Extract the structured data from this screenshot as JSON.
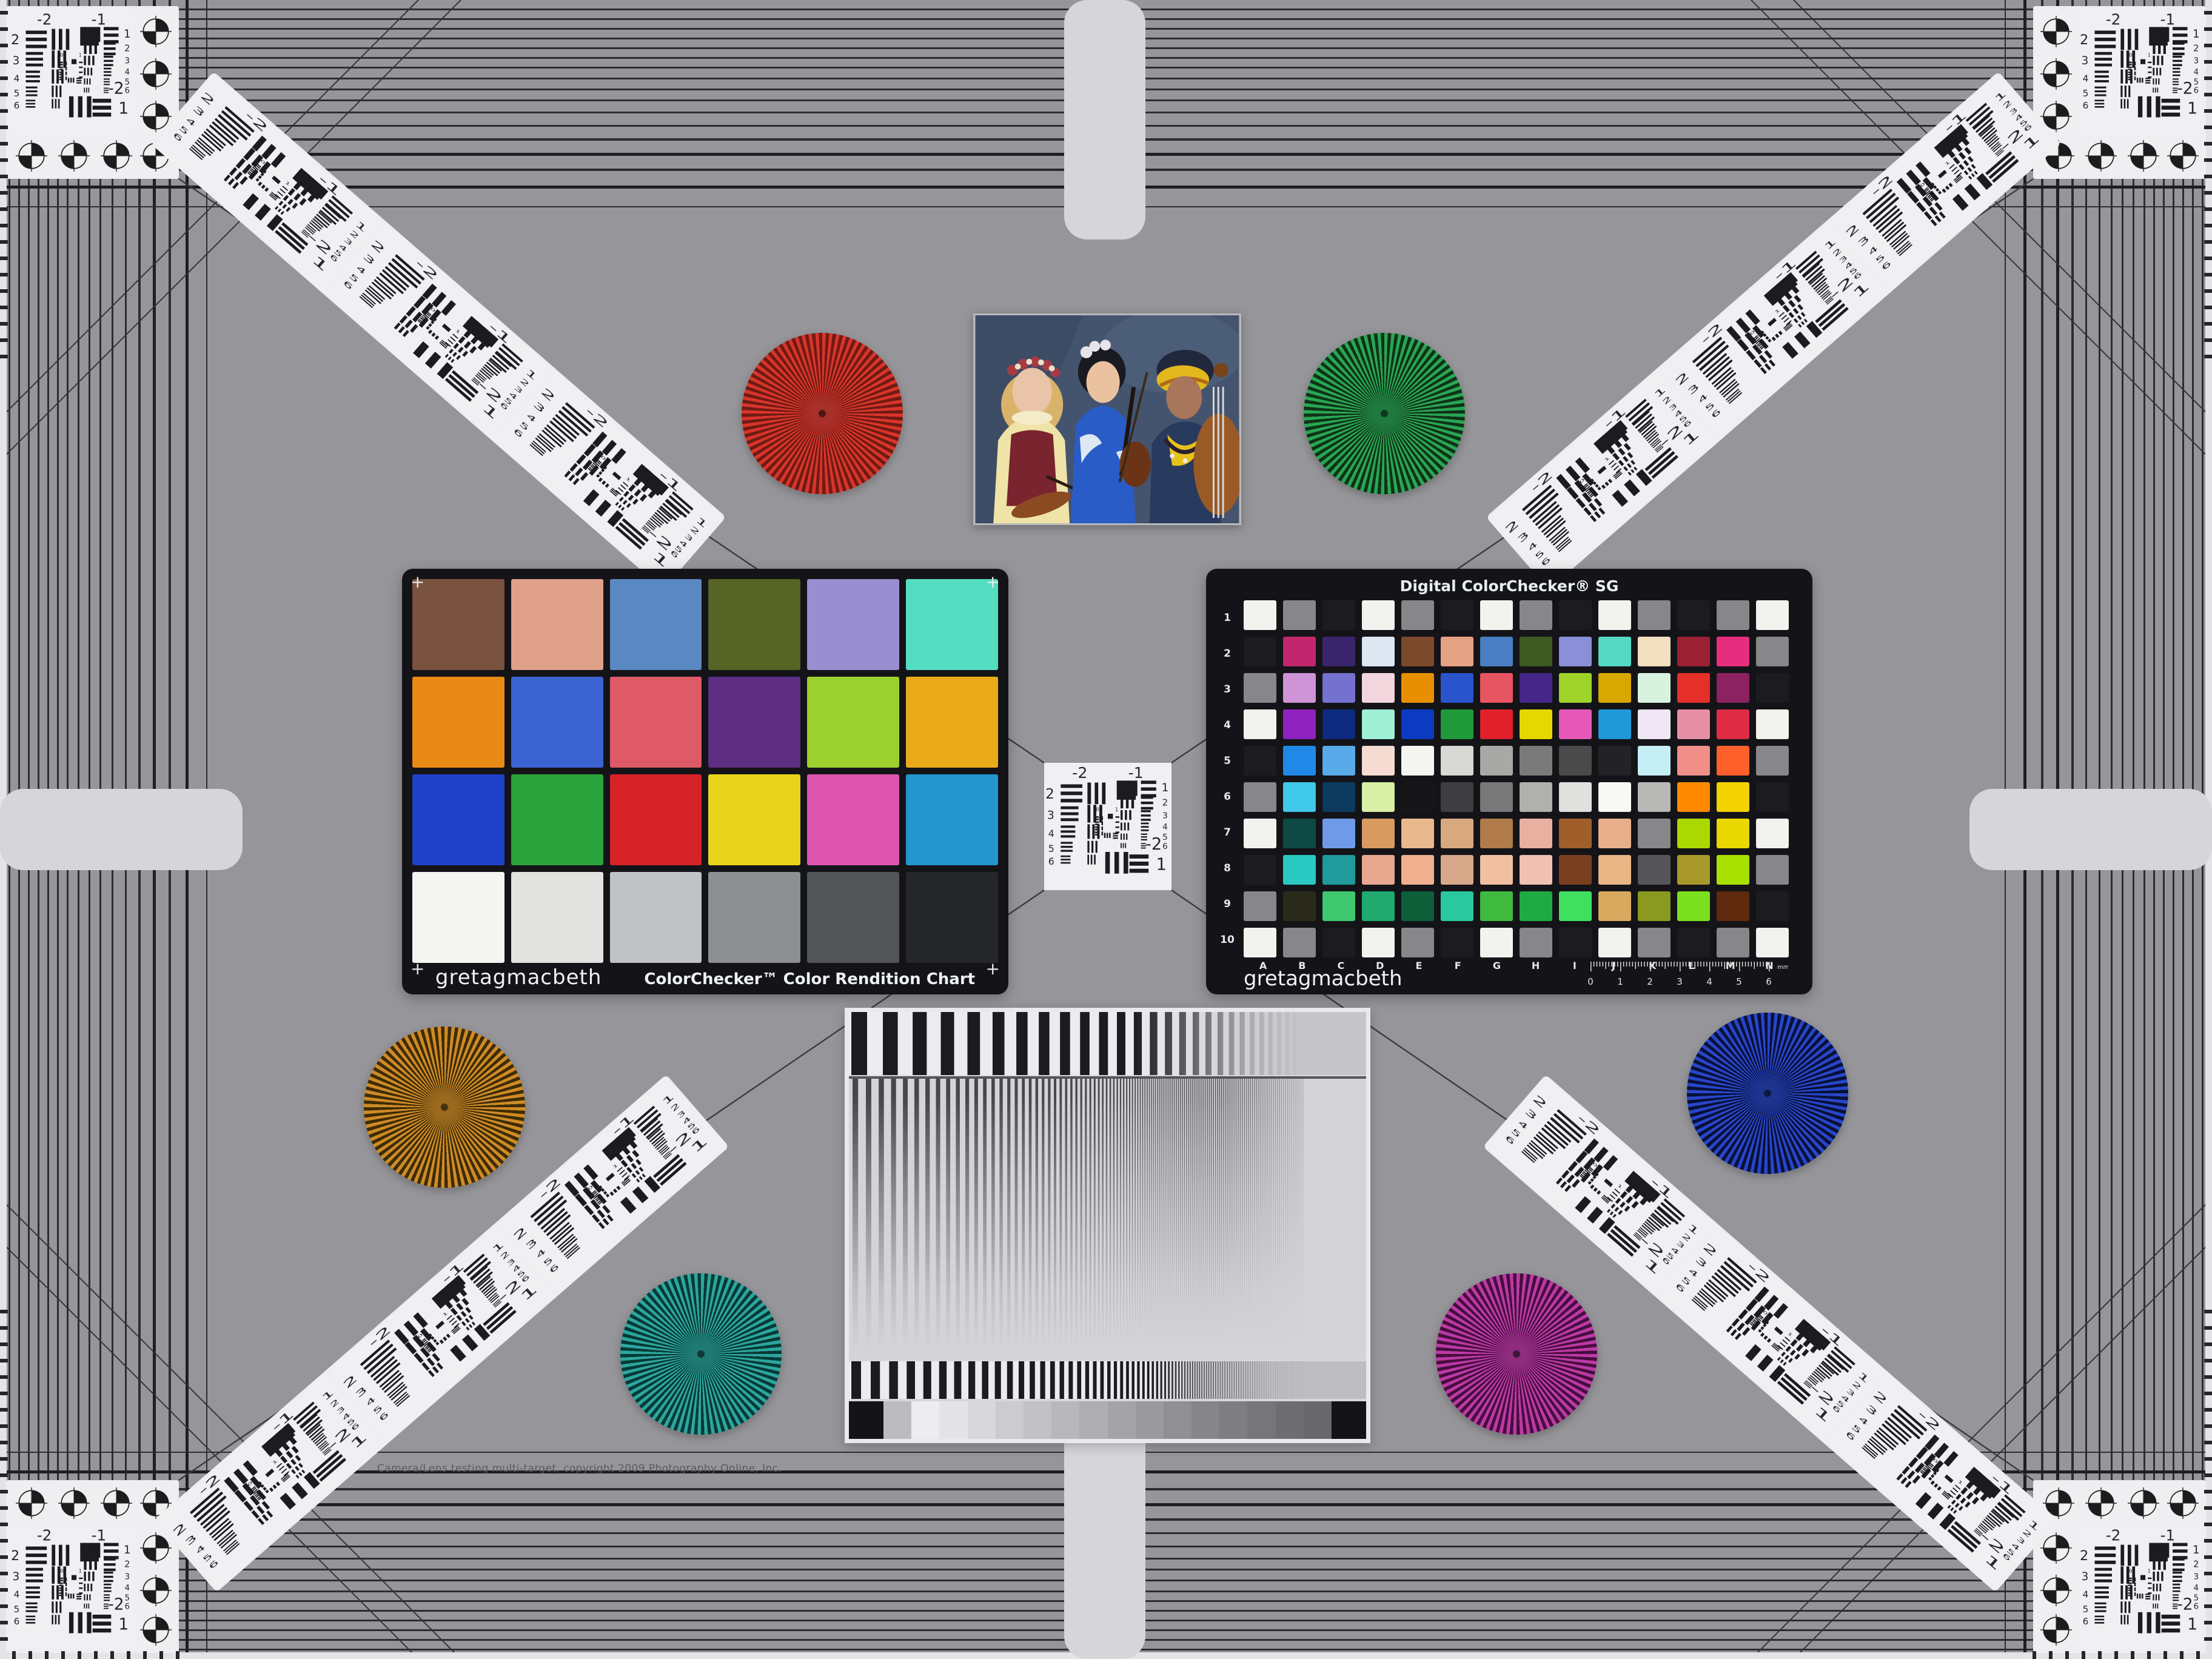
{
  "page": {
    "background": "#96969a",
    "copyright": "Camera/Lens testing multi-target, copyright 2009 Photography Online, Inc."
  },
  "colorchecker": {
    "brand": "gretagmacbeth",
    "title": "ColorChecker™ Color Rendition Chart",
    "corner_mark": "+",
    "rows": [
      [
        "#7a5240",
        "#dfa089",
        "#5a88c2",
        "#566426",
        "#998fd0",
        "#55ddc2"
      ],
      [
        "#e98a16",
        "#3c63d2",
        "#dd5a66",
        "#5e2e82",
        "#9cd02e",
        "#eaab1a"
      ],
      [
        "#2040c8",
        "#2ba33c",
        "#d8222a",
        "#e8d41a",
        "#dd55ae",
        "#2496cf"
      ],
      [
        "#f4f4f0",
        "#e2e3e1",
        "#c0c3c3",
        "#8d9091",
        "#535657",
        "#242628"
      ]
    ]
  },
  "sg": {
    "title": "Digital ColorChecker® SG",
    "brand": "gretagmacbeth",
    "col_labels": [
      "A",
      "B",
      "C",
      "D",
      "E",
      "F",
      "G",
      "H",
      "I",
      "J",
      "K",
      "L",
      "M",
      "N"
    ],
    "row_labels": [
      "1",
      "2",
      "3",
      "4",
      "5",
      "6",
      "7",
      "8",
      "9",
      "10"
    ],
    "ruler": {
      "numbers": [
        "0",
        "1",
        "2",
        "3",
        "4",
        "5",
        "6"
      ],
      "unit": "mm"
    },
    "colors": [
      [
        "#f2f2ee",
        "#87878a",
        "#1c1c1e",
        "#f2f2ee",
        "#87878a",
        "#1c1c1e",
        "#f2f2ee",
        "#87878a",
        "#1c1c1e",
        "#f2f2ee",
        "#87878a",
        "#1c1c1e",
        "#87878a",
        "#f2f2ee"
      ],
      [
        "#1c1c1e",
        "#c2266d",
        "#38256b",
        "#dce7f2",
        "#7b4a2a",
        "#e5a183",
        "#4b7fc4",
        "#3f5a20",
        "#8a8fd8",
        "#55d8c2",
        "#f2dfc0",
        "#9a2034",
        "#e62e7e",
        "#87878a"
      ],
      [
        "#87878a",
        "#cf93d8",
        "#7571cf",
        "#f2d5dd",
        "#e88f00",
        "#2a54cc",
        "#e85562",
        "#45278a",
        "#9fd32a",
        "#d8a800",
        "#d8f2e0",
        "#e5302a",
        "#8c2260",
        "#1c1c1e"
      ],
      [
        "#f2f2ee",
        "#8f22bf",
        "#0d2b7e",
        "#9ff0d5",
        "#0c3bc2",
        "#20993a",
        "#e0202a",
        "#e5d800",
        "#e658b8",
        "#2099d8",
        "#efe6f3",
        "#e78fa5",
        "#e02b45",
        "#f2f2ee"
      ],
      [
        "#1c1c1e",
        "#2089e8",
        "#58aae8",
        "#f5dbd2",
        "#f5f5f2",
        "#d8d8d5",
        "#a8a8a6",
        "#7a7a7a",
        "#4a4a4a",
        "#232325",
        "#c5eef5",
        "#ef8f88",
        "#ff5f2a",
        "#87878a"
      ],
      [
        "#87878a",
        "#3fc8e8",
        "#0d3a5f",
        "#d8f0a5",
        "#161618",
        "#3f3f41",
        "#787878",
        "#b0b0ae",
        "#e0e0de",
        "#f8f8f5",
        "#b8b8b6",
        "#ff8a00",
        "#f2d200",
        "#1c1c1e"
      ],
      [
        "#f2f2ee",
        "#0d4a44",
        "#6f9ae8",
        "#d89a5f",
        "#e8b88f",
        "#d8a87f",
        "#b07a4a",
        "#e8b0a0",
        "#a05f2a",
        "#e8b08a",
        "#87878a",
        "#aad800",
        "#e8d800",
        "#f2f2ee"
      ],
      [
        "#1c1c1e",
        "#2ac8c2",
        "#209a9a",
        "#e8a88f",
        "#f0b08f",
        "#d8a88a",
        "#f0c0a0",
        "#f0c0b0",
        "#7a3f1f",
        "#e8b585",
        "#555557",
        "#a8992a",
        "#aae000",
        "#87878a"
      ],
      [
        "#87878a",
        "#2a2a1a",
        "#3fc86f",
        "#20aa6f",
        "#0d5f3a",
        "#2ac89f",
        "#3fba3f",
        "#20aa44",
        "#3fe060",
        "#d8a85f",
        "#8a9a20",
        "#7ae020",
        "#5f2a0d",
        "#1c1c1e"
      ],
      [
        "#f2f2ee",
        "#87878a",
        "#1c1c1e",
        "#f2f2ee",
        "#87878a",
        "#1c1c1e",
        "#f2f2ee",
        "#87878a",
        "#1c1c1e",
        "#f2f2ee",
        "#87878a",
        "#1c1c1e",
        "#87878a",
        "#f2f2ee"
      ]
    ]
  },
  "usaf": {
    "top": [
      "-2",
      "-1"
    ],
    "left": [
      "2",
      "3",
      "4",
      "5",
      "6"
    ],
    "right": [
      "1",
      "2",
      "3",
      "4",
      "5",
      "6"
    ],
    "bottom": [
      "-2",
      "1"
    ],
    "center": [
      "0",
      "1"
    ]
  },
  "stars": [
    {
      "name": "red",
      "bright": "#d8352a",
      "dark": "#701a14",
      "mid": "#a8302a"
    },
    {
      "name": "green",
      "bright": "#2aa653",
      "dark": "#0e3318",
      "mid": "#1f7a3f"
    },
    {
      "name": "orange",
      "bright": "#cf8b26",
      "dark": "#3e2c06",
      "mid": "#9a6a1e"
    },
    {
      "name": "teal",
      "bright": "#2da69e",
      "dark": "#063a36",
      "mid": "#1f7a74"
    },
    {
      "name": "blue",
      "bright": "#2746c8",
      "dark": "#081038",
      "mid": "#1d348f"
    },
    {
      "name": "magenta",
      "bright": "#bb3aa4",
      "dark": "#470d3f",
      "mid": "#8f2c7d"
    }
  ],
  "sweep": {
    "gray_steps": [
      "#141416",
      "#bcbcc0",
      "#ededf0",
      "#e4e4e8",
      "#d8d8dc",
      "#cccccf",
      "#c2c2c6",
      "#b8b8bc",
      "#aeaeb2",
      "#a4a4a8",
      "#9a9a9e",
      "#909094",
      "#86868a",
      "#7e7e82",
      "#767679",
      "#6e6e72",
      "#68686c",
      "#141416"
    ]
  },
  "photo": {
    "backdrop": "#44546e",
    "left_figure": {
      "blouse": "#efe3a8",
      "vest": "#7a2430",
      "hair": "#d9b36a",
      "skin": "#e9c4a8"
    },
    "middle_figure": {
      "kimono": "#2a5cc8",
      "hair": "#1a1a22",
      "skin": "#eac2a0"
    },
    "right_figure": {
      "top": "#283a5e",
      "turban": "#e2b81e",
      "skin": "#a8765a",
      "beads": "#e8c21a"
    },
    "instrument_wood": "#8a4a22"
  }
}
